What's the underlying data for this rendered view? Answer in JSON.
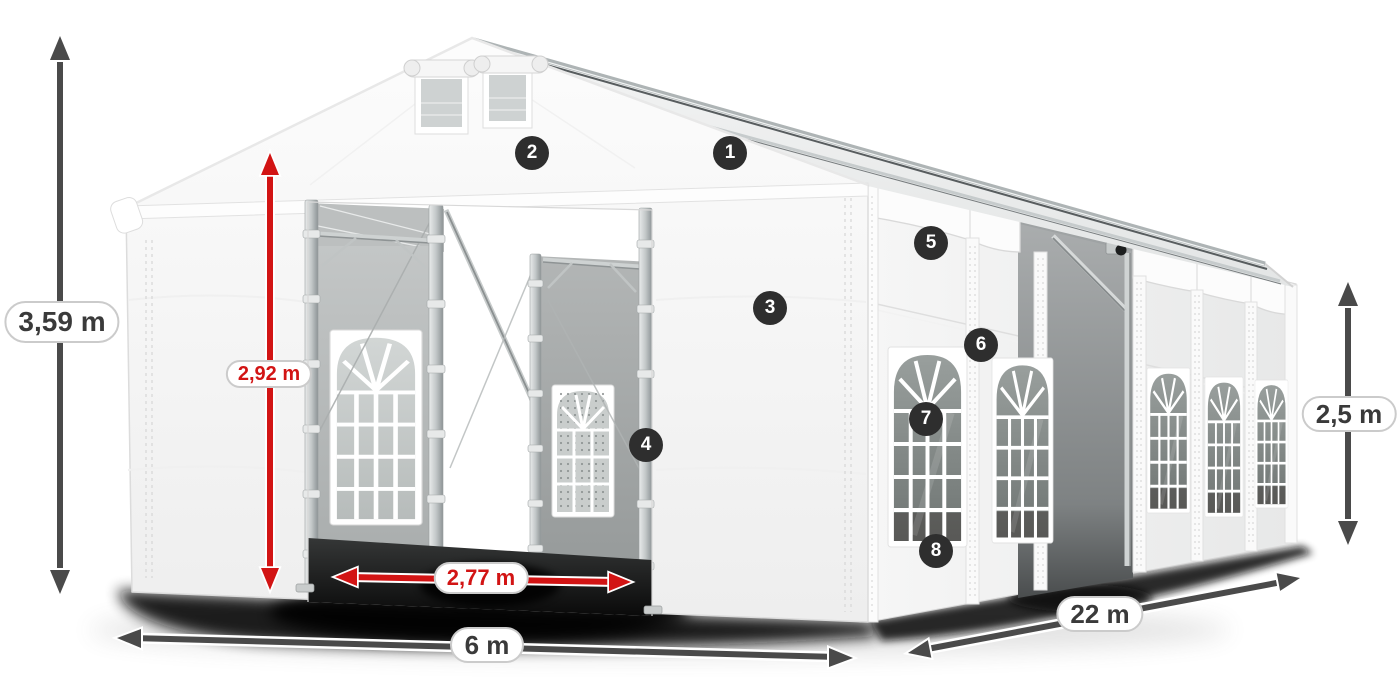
{
  "diagram": {
    "subject": "party-tent-dimension-diagram",
    "colors": {
      "dimension_arrow": "#4a4a4a",
      "dimension_text": "#3a3a3a",
      "highlight_arrow": "#d21414",
      "highlight_text": "#d21414",
      "pill_background": "#ffffff",
      "pill_border": "#cbcbcb",
      "callout_background": "#2e2e2e",
      "callout_text": "#ffffff"
    },
    "dimensions": {
      "total_height": {
        "label": "3,59 m",
        "style": "gray",
        "orientation": "vertical"
      },
      "entrance_height": {
        "label": "2,92 m",
        "style": "red",
        "orientation": "vertical"
      },
      "entrance_width": {
        "label": "2,77 m",
        "style": "red",
        "orientation": "horizontal"
      },
      "gable_width": {
        "label": "6 m",
        "style": "gray",
        "orientation": "horizontal"
      },
      "side_length": {
        "label": "22 m",
        "style": "gray",
        "orientation": "diagonal"
      },
      "side_height": {
        "label": "2,5 m",
        "style": "gray",
        "orientation": "vertical"
      }
    },
    "callouts": [
      {
        "number": "1"
      },
      {
        "number": "2"
      },
      {
        "number": "3"
      },
      {
        "number": "4"
      },
      {
        "number": "5"
      },
      {
        "number": "6"
      },
      {
        "number": "7"
      },
      {
        "number": "8"
      }
    ]
  }
}
